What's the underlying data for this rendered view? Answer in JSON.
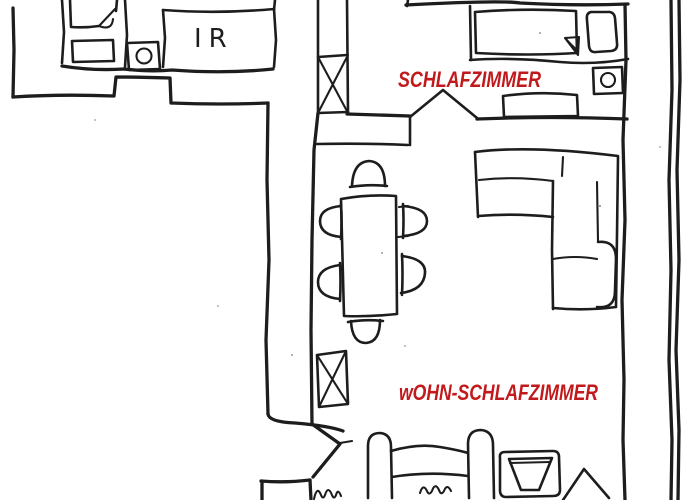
{
  "floorplan": {
    "labels": {
      "bedroom": "SCHLAFZIMMER",
      "living_bedroom": "wOHN-SCHLAFZIMMER",
      "room_ir": "IR"
    },
    "colors": {
      "label_red": "#C2191C",
      "ink": "#1d1d1d",
      "background": "#ffffff"
    }
  }
}
